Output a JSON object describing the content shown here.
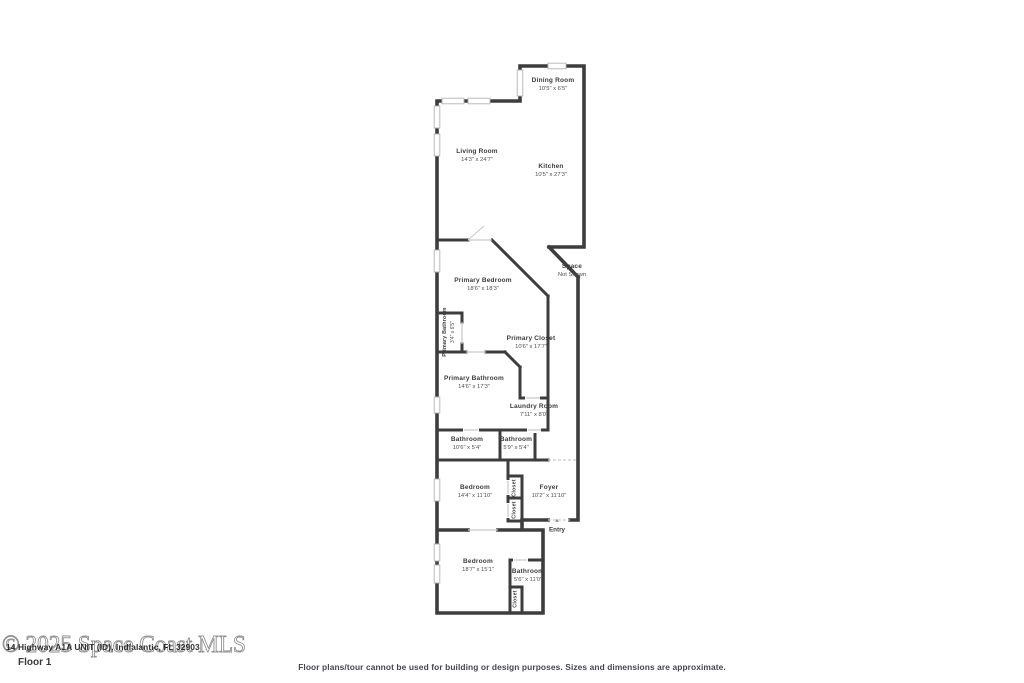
{
  "floorplan": {
    "rooms": [
      {
        "id": "dining-room",
        "name": "Dining Room",
        "dims": "10'5\" x 6'5\"",
        "x": 553,
        "y": 85,
        "rot": false,
        "small": false
      },
      {
        "id": "living-room",
        "name": "Living Room",
        "dims": "14'3\" x 24'7\"",
        "x": 477,
        "y": 156,
        "rot": false,
        "small": false
      },
      {
        "id": "kitchen",
        "name": "Kitchen",
        "dims": "10'5\" x 27'3\"",
        "x": 551,
        "y": 171,
        "rot": false,
        "small": false
      },
      {
        "id": "primary-bedroom",
        "name": "Primary Bedroom",
        "dims": "18'6\" x 18'3\"",
        "x": 483,
        "y": 285,
        "rot": false,
        "small": false
      },
      {
        "id": "space-not-shown",
        "name": "Space",
        "dims": "Not Shown",
        "x": 572,
        "y": 271,
        "rot": false,
        "small": false
      },
      {
        "id": "primary-closet",
        "name": "Primary Closet",
        "dims": "10'6\" x 17'7\"",
        "x": 531,
        "y": 343,
        "rot": false,
        "small": false
      },
      {
        "id": "primary-bathroom-wc",
        "name": "Primary Bathroom",
        "dims": "3'4\" x 6'5\"",
        "x": 449,
        "y": 332,
        "rot": true,
        "small": true
      },
      {
        "id": "primary-bathroom",
        "name": "Primary Bathroom",
        "dims": "14'6\" x 17'3\"",
        "x": 474,
        "y": 383,
        "rot": false,
        "small": false
      },
      {
        "id": "laundry-room",
        "name": "Laundry Room",
        "dims": "7'11\" x 8'0\"",
        "x": 534,
        "y": 411,
        "rot": false,
        "small": false
      },
      {
        "id": "bathroom-hall",
        "name": "Bathroom",
        "dims": "10'6\" x 5'4\"",
        "x": 467,
        "y": 444,
        "rot": false,
        "small": false
      },
      {
        "id": "bathroom-2",
        "name": "Bathroom",
        "dims": "5'9\" x 5'4\"",
        "x": 516,
        "y": 444,
        "rot": false,
        "small": false
      },
      {
        "id": "bedroom-1",
        "name": "Bedroom",
        "dims": "14'4\" x 11'10\"",
        "x": 475,
        "y": 492,
        "rot": false,
        "small": false
      },
      {
        "id": "foyer",
        "name": "Foyer",
        "dims": "10'2\" x 11'10\"",
        "x": 549,
        "y": 492,
        "rot": false,
        "small": false
      },
      {
        "id": "closet-1",
        "name": "Closet",
        "dims": "",
        "x": 515,
        "y": 488,
        "rot": true,
        "small": true
      },
      {
        "id": "closet-2",
        "name": "Closet",
        "dims": "",
        "x": 515,
        "y": 510,
        "rot": true,
        "small": true
      },
      {
        "id": "bedroom-2",
        "name": "Bedroom",
        "dims": "18'7\" x 15'1\"",
        "x": 478,
        "y": 566,
        "rot": false,
        "small": false
      },
      {
        "id": "bathroom-3",
        "name": "Bathroom",
        "dims": "5'6\" x 11'0\"",
        "x": 528,
        "y": 576,
        "rot": false,
        "small": false
      },
      {
        "id": "closet-3",
        "name": "Closet",
        "dims": "",
        "x": 516,
        "y": 599,
        "rot": true,
        "small": true
      }
    ],
    "entry": {
      "label": "Entry",
      "icon": "▲"
    }
  },
  "watermark": {
    "copyright": "© 2025 Space Coast MLS",
    "address": "14 Highway A1A UNIT (ID), Indialantic, FL 32903"
  },
  "footer": {
    "floor_label": "Floor 1",
    "disclaimer": "Floor plans/tour cannot be used for building or design purposes. Sizes and dimensions are approximate."
  },
  "colors": {
    "wall": "#3d3d3d",
    "label_text": "#3c3c3c",
    "watermark_outline": "#909090",
    "disclaimer_text": "#45455a"
  }
}
